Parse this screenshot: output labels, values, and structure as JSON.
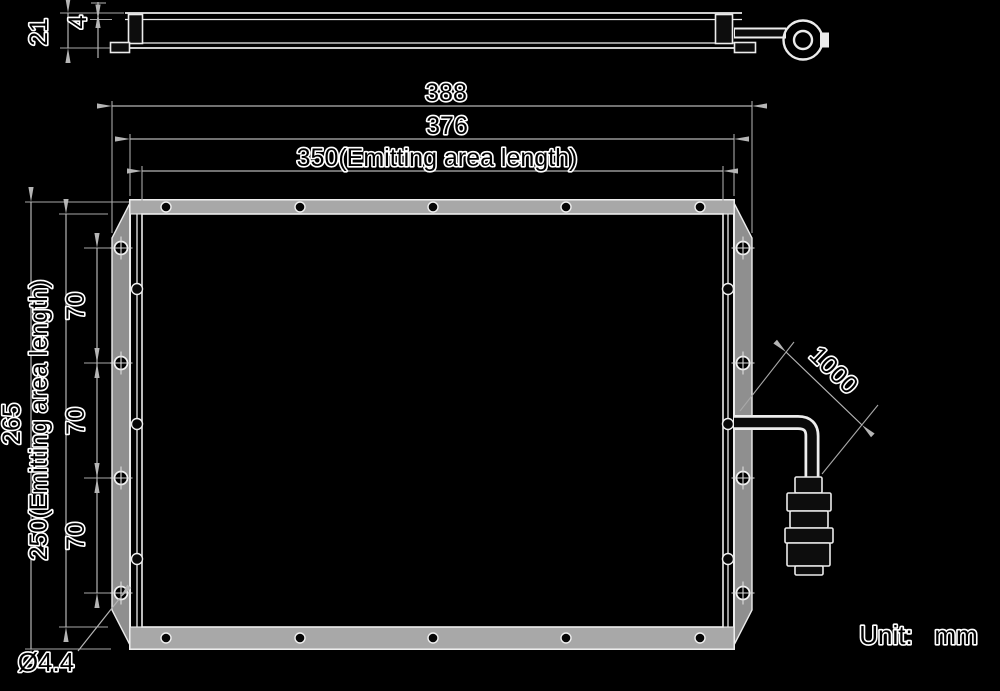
{
  "drawing": {
    "type": "technical-dimension-drawing",
    "unit_note": {
      "label": "Unit:",
      "value": "mm"
    },
    "dimensions": {
      "overall_width": "388",
      "frame_width": "376",
      "emitting_area_width": "350(Emitting area length)",
      "overall_height": "265",
      "emitting_area_height": "250(Emitting area length)",
      "hole_pitch_top": "70",
      "hole_pitch_middle": "70",
      "hole_pitch_bottom": "70",
      "overall_thickness": "21",
      "panel_thickness": "4",
      "cable_length": "1000",
      "mounting_hole_diameter": "Ø4.4"
    },
    "colors": {
      "background": "#000000",
      "object_line": "#ececec",
      "dim_line": "#b5b5b5",
      "ext_line": "#a8a8a8",
      "frame_fill": "#a8a8a8",
      "flange_fill": "#8f8f8f",
      "dark_fill": "#0d0d0d",
      "text_fill": "#000000",
      "text_outline": "#ffffff"
    }
  }
}
